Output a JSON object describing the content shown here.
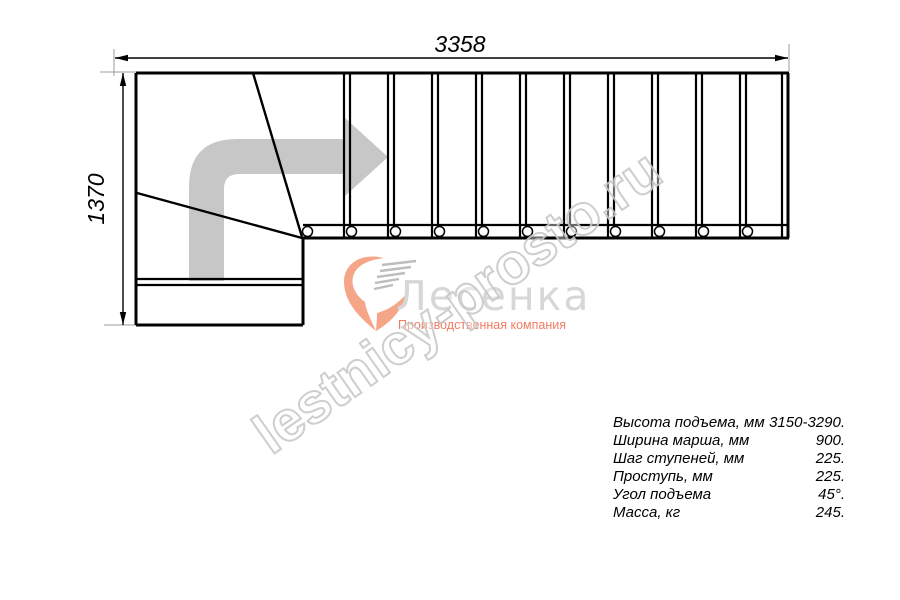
{
  "drawing": {
    "title_role": "staircase-plan-top-view",
    "dim_horizontal": "3358",
    "dim_vertical": "1370",
    "treads_straight_flight": 11,
    "line_color": "#000000",
    "arrow_color": "#c7c7c7",
    "extension_line_color": "#9c9c9c"
  },
  "logo": {
    "name": "Лесенка",
    "subtitle": "Производственная компания",
    "accent_color": "#f6a688",
    "name_color": "#d7d7d7",
    "subtitle_color": "#ee7d61"
  },
  "watermark": {
    "text": "lestnicy-prosto.ru",
    "stroke_color": "#c9c9c9"
  },
  "specs": {
    "rows": [
      {
        "label": "Высота подъема, мм",
        "value": "3150-3290."
      },
      {
        "label": "Ширина марша, мм",
        "value": "900."
      },
      {
        "label": "Шаг ступеней, мм",
        "value": "225."
      },
      {
        "label": "Проступь, мм",
        "value": "225."
      },
      {
        "label": "Угол подъема",
        "value": "45°."
      },
      {
        "label": "Масса, кг",
        "value": "245."
      }
    ]
  }
}
